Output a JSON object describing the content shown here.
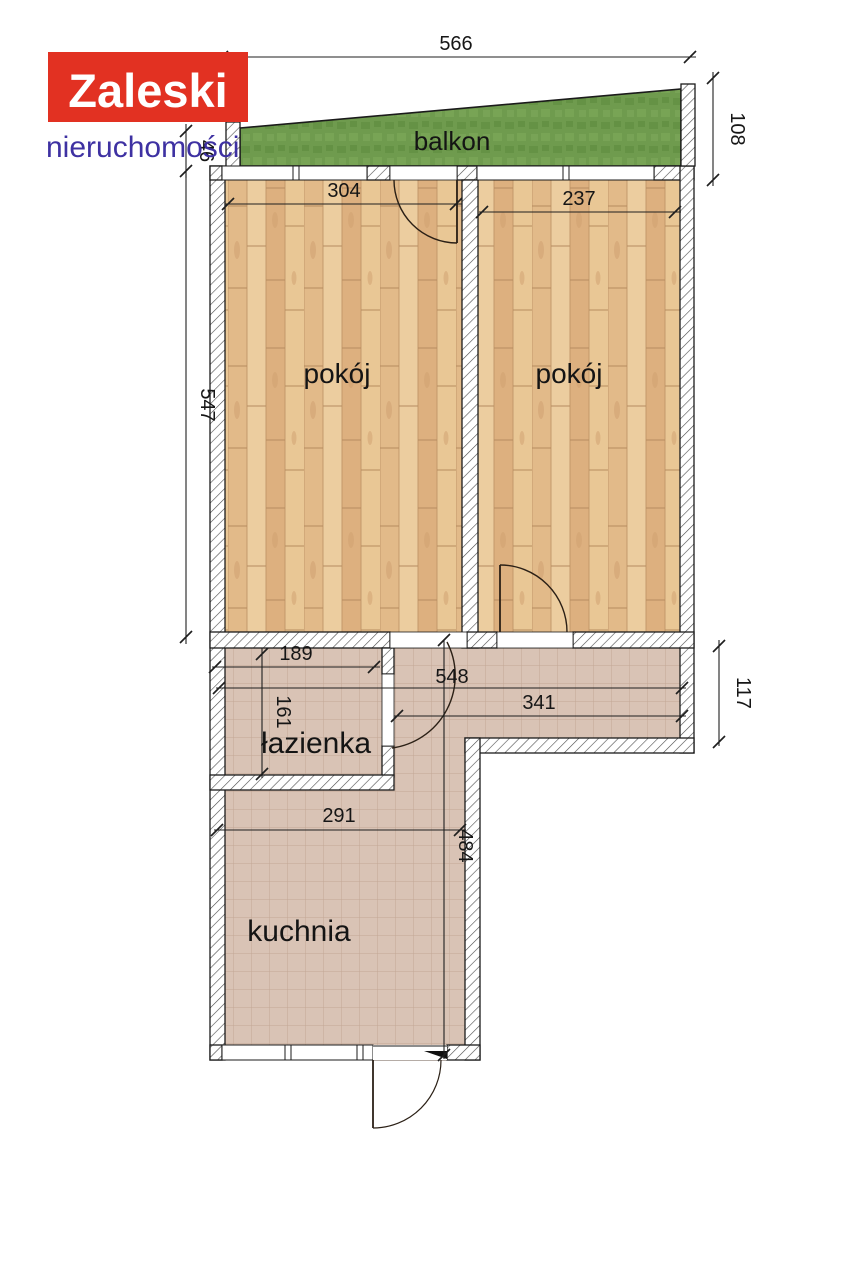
{
  "logo": {
    "title": "Zaleski",
    "subtitle": "nieruchomości",
    "bg_color": "#e23122",
    "title_color": "#ffffff",
    "subtitle_color": "#3e31a2"
  },
  "labels": {
    "balcony": "balkon",
    "room1": "pokój",
    "room2": "pokój",
    "bathroom": "łazienka",
    "kitchen": "kuchnia"
  },
  "dimensions": {
    "balcony_width": "566",
    "balcony_depth_right": "108",
    "balcony_depth_left": "46",
    "rooms_depth": "547",
    "room1_width": "304",
    "room2_width": "237",
    "bathroom_width": "189",
    "bathroom_depth": "161",
    "hall_width_total": "548",
    "hall_width_right": "341",
    "hall_depth": "117",
    "kitchen_width": "291",
    "kitchen_depth": "484"
  },
  "colors": {
    "grass": "#6f9b4e",
    "wood": "#e7c497",
    "tile": "#d9c3b5",
    "wall_outline": "#1b1b1b"
  }
}
